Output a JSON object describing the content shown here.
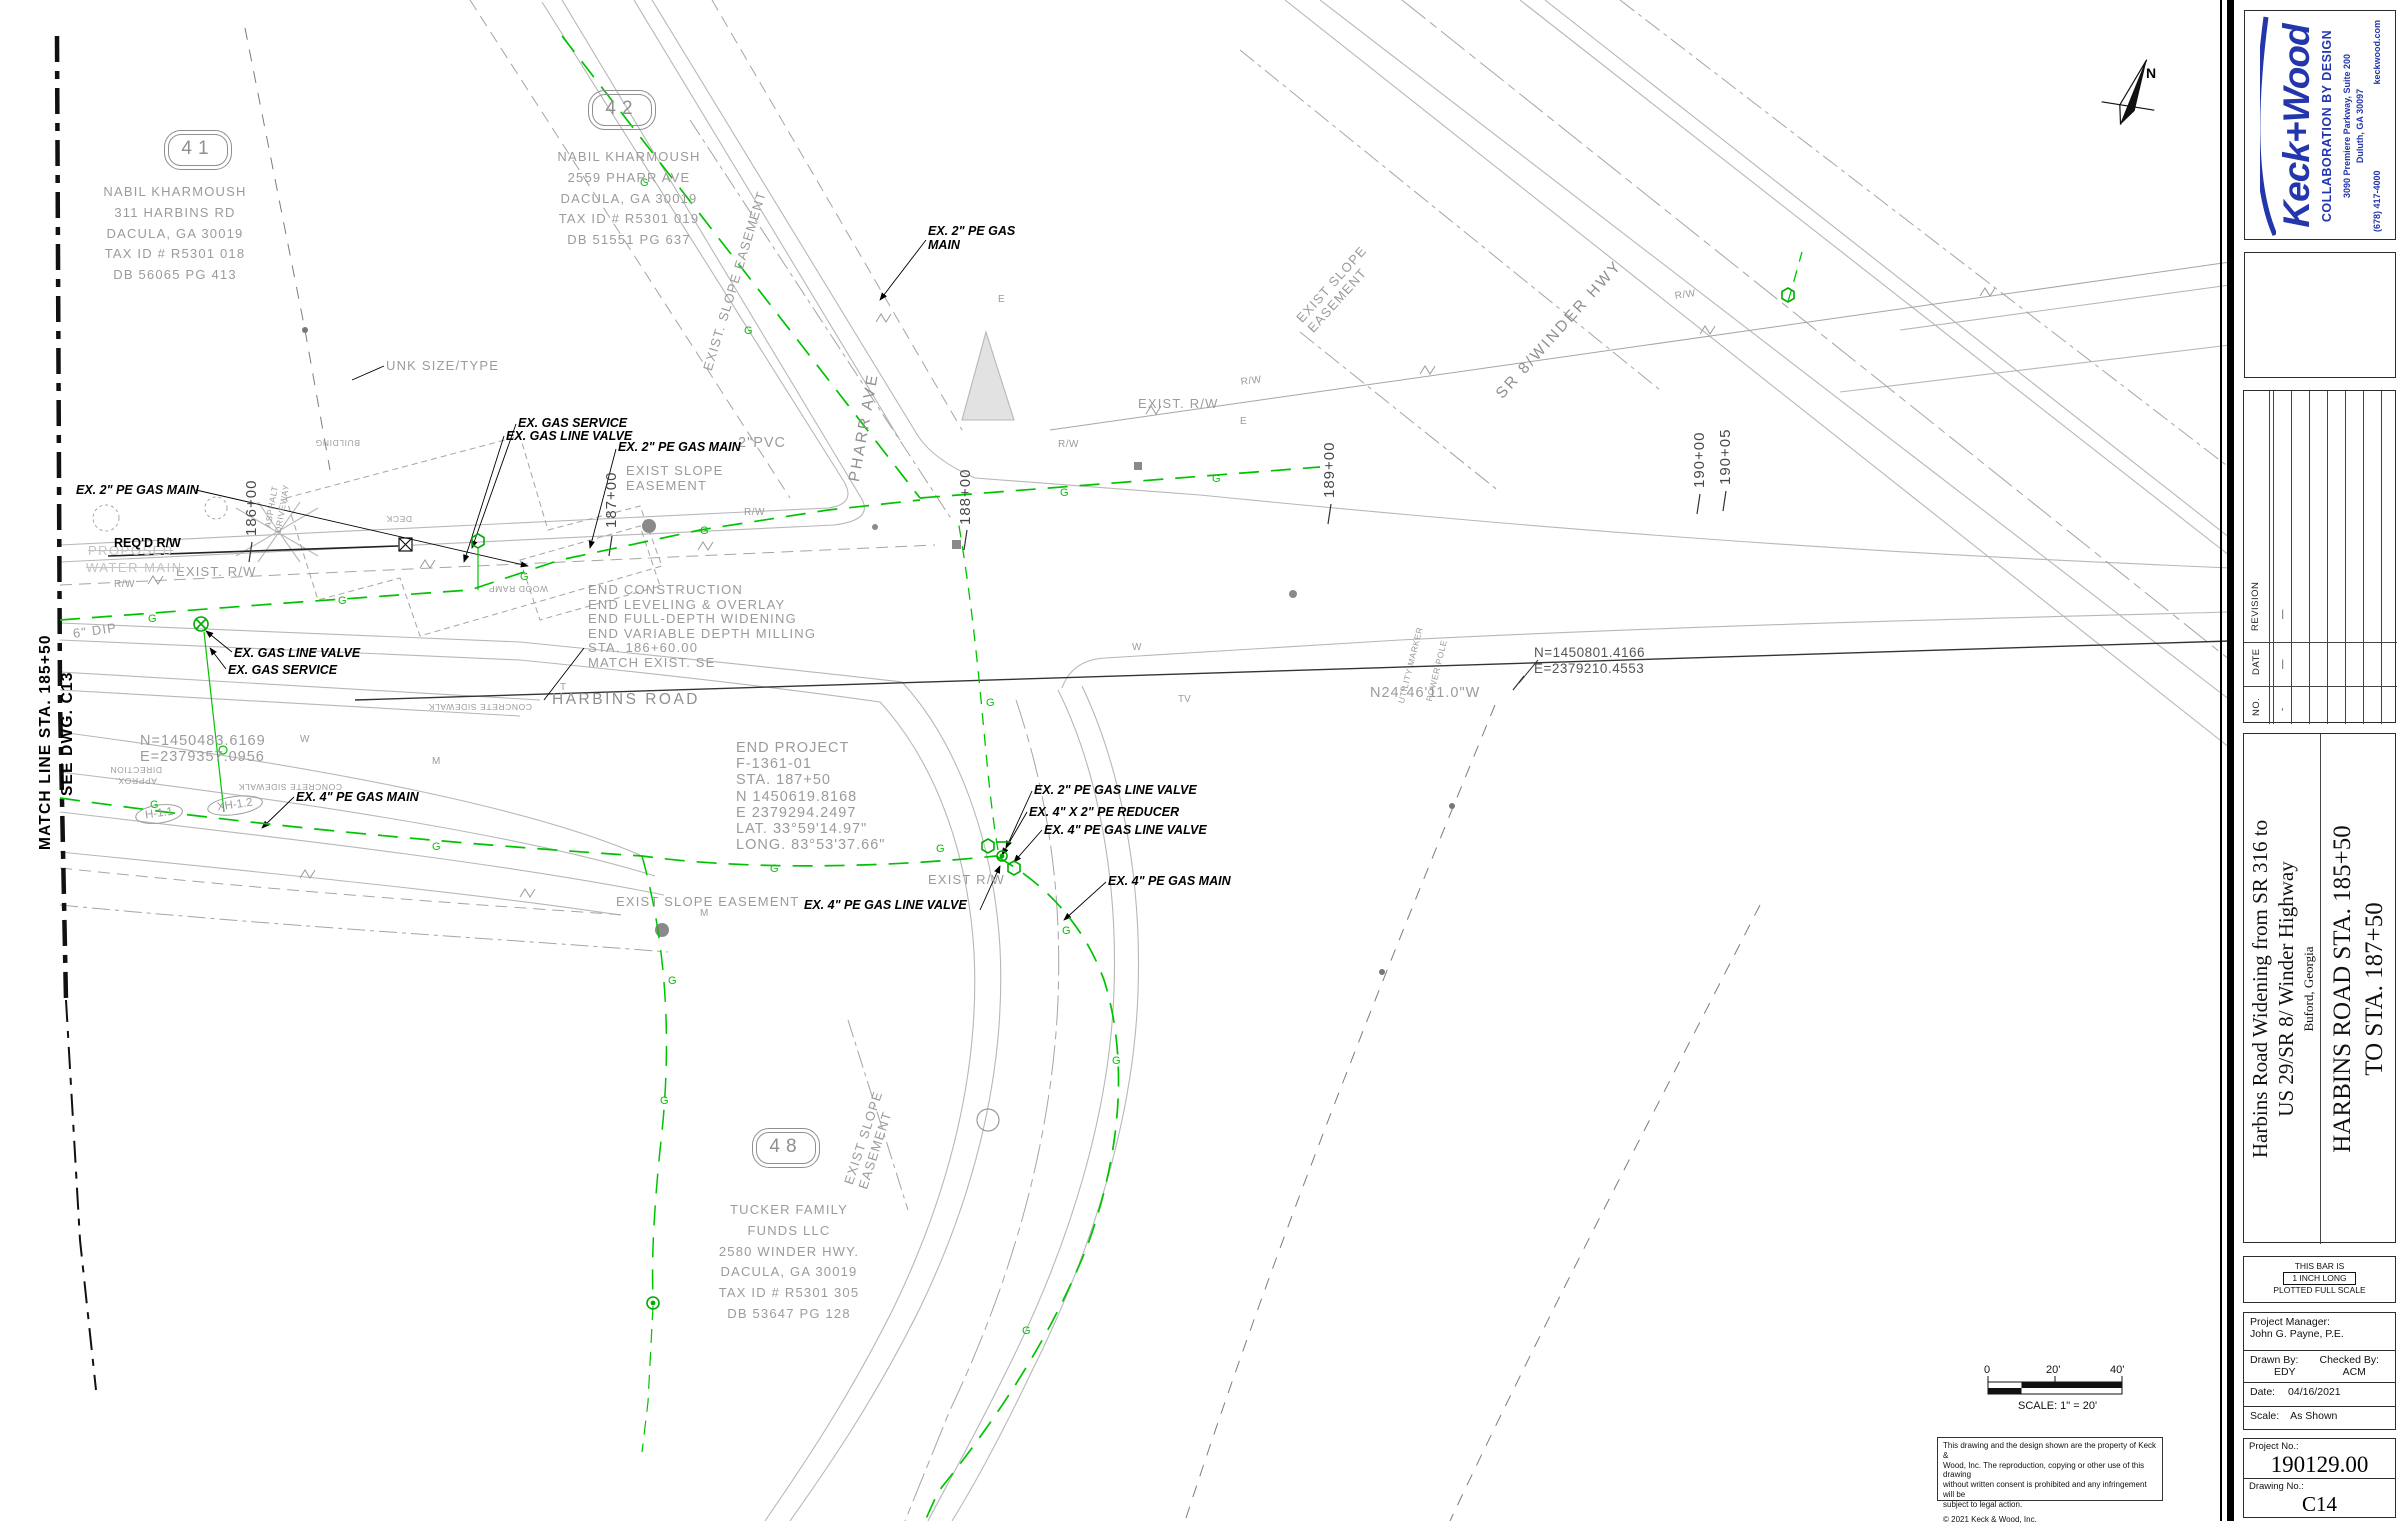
{
  "titleblock": {
    "firm": {
      "logo": "Keck+Wood",
      "tagline": "COLLABORATION BY DESIGN",
      "address1": "3090 Premiere Parkway, Suite 200",
      "address2": "Duluth, GA  30097",
      "phone": "(678) 417-4000",
      "web": "keckwood.com",
      "brand_color": "#2336ac"
    },
    "revision_table": {
      "col_no": "NO.",
      "col_date": "DATE",
      "col_revision": "REVISION",
      "rows": [
        {
          "no": "-",
          "date": "—",
          "revision": "—"
        }
      ]
    },
    "project_title_line1": "Harbins Road Widening from SR 316 to",
    "project_title_line2": "US 29/SR 8/ Winder Highway",
    "project_location": "Buford, Georgia",
    "sheet_title_line1": "HARBINS ROAD STA. 185+50",
    "sheet_title_line2": "TO STA. 187+50",
    "bar_note_1": "THIS BAR IS",
    "bar_note_2": "1 INCH LONG",
    "bar_note_3": "PLOTTED FULL SCALE",
    "info": {
      "pm_label": "Project Manager:",
      "pm": "John G. Payne, P.E.",
      "drawn_label": "Drawn By:",
      "drawn": "EDY",
      "checked_label": "Checked By:",
      "checked": "ACM",
      "date_label": "Date:",
      "date": "04/16/2021",
      "scale_label": "Scale:",
      "scale": "As Shown"
    },
    "project_no_label": "Project No.:",
    "project_no": "190129.00",
    "drawing_no_label": "Drawing No.:",
    "drawing_no": "C14"
  },
  "plan": {
    "scalebar": {
      "zero": "0",
      "mid": "20'",
      "end": "40'",
      "caption": "SCALE: 1\" =  20'"
    },
    "copyright": {
      "lines": [
        "This drawing and the design shown are the property of Keck &",
        "Wood, Inc. The reproduction, copying or other use of this drawing",
        "without written consent is prohibited and any infringement will be",
        "subject to legal action."
      ],
      "notice": "©  2021 Keck & Wood, Inc."
    },
    "linetype": {
      "gas": "G",
      "e": "E",
      "w": "W",
      "m": "M",
      "t": "T",
      "tv": "TV"
    },
    "labels": [
      {
        "name": "parcel-41-bubble",
        "text": "41",
        "x": 168,
        "y": 134,
        "w": 58,
        "cls": "bubble"
      },
      {
        "name": "parcel-41-address",
        "text": "NABIL KHARMOUSH\n311 HARBINS RD\nDACULA, GA 30019\nTAX ID # R5301 018\nDB 56065 PG 413",
        "x": 66,
        "y": 182,
        "w": 218,
        "cls": "cad loose center"
      },
      {
        "name": "parcel-42-bubble",
        "text": "42",
        "x": 592,
        "y": 94,
        "w": 58,
        "cls": "bubble"
      },
      {
        "name": "parcel-42-address",
        "text": "NABIL KHARMOUSH\n2559 PHARR AVE\nDACULA, GA 30019\nTAX ID # R5301 019\nDB 51551 PG 637",
        "x": 520,
        "y": 147,
        "w": 218,
        "cls": "cad loose center"
      },
      {
        "name": "parcel-48-bubble",
        "text": "48",
        "x": 756,
        "y": 1132,
        "w": 58,
        "cls": "bubble"
      },
      {
        "name": "parcel-48-address",
        "text": "TUCKER FAMILY\nFUNDS LLC\n2580 WINDER HWY.\nDACULA, GA 30019\nTAX ID # R5301 305\nDB 53647 PG 128",
        "x": 680,
        "y": 1200,
        "w": 218,
        "cls": "cad loose center"
      },
      {
        "name": "match-line-label",
        "text": "MATCH LINE STA. 185+50",
        "x": 36,
        "y": 850,
        "rot": -90,
        "cls": "mline"
      },
      {
        "name": "match-line-dwg-ref",
        "text": "SEE DWG. C13",
        "x": 58,
        "y": 796,
        "rot": -90,
        "cls": "mline"
      },
      {
        "name": "road-name-harbins",
        "text": "HARBINS ROAD",
        "x": 552,
        "y": 690,
        "cls": "cadlg"
      },
      {
        "name": "road-name-pharr",
        "text": "PHARR AVE",
        "x": 845,
        "y": 480,
        "rot": -80,
        "cls": "cadlg"
      },
      {
        "name": "road-name-sr8",
        "text": "SR 8/WINDER HWY",
        "x": 1492,
        "y": 390,
        "rot": -48,
        "cls": "cadlg"
      },
      {
        "name": "station-186",
        "text": "186+00",
        "x": 242,
        "y": 536,
        "rot": -90,
        "cls": "sta"
      },
      {
        "name": "station-187",
        "text": "187+00",
        "x": 602,
        "y": 528,
        "rot": -90,
        "cls": "sta"
      },
      {
        "name": "station-188",
        "text": "188+00",
        "x": 956,
        "y": 525,
        "rot": -90,
        "cls": "sta"
      },
      {
        "name": "station-189",
        "text": "189+00",
        "x": 1320,
        "y": 498,
        "rot": -90,
        "cls": "sta"
      },
      {
        "name": "station-190",
        "text": "190+00",
        "x": 1690,
        "y": 488,
        "rot": -90,
        "cls": "sta"
      },
      {
        "name": "station-190-05",
        "text": "190+05",
        "x": 1716,
        "y": 485,
        "rot": -90,
        "cls": "sta"
      },
      {
        "name": "end-construction-note",
        "text": "END CONSTRUCTION\nEND LEVELING & OVERLAY\nEND FULL-DEPTH WIDENING\nEND VARIABLE DEPTH MILLING\nSTA. 186+60.00\nMATCH EXIST. SE",
        "x": 588,
        "y": 583,
        "cls": "cad tight"
      },
      {
        "name": "end-project-note",
        "text": "END PROJECT\nF-1361-01\nSTA. 187+50\nN 1450619.8168\nE 2379294.2497\nLAT. 33°59'14.97\"\nLONG. 83°53'37.66\"",
        "x": 736,
        "y": 740,
        "cls": "cadbig tight"
      },
      {
        "name": "coordinate-west",
        "text": "N=1450483.6169\nE=2379357.0956",
        "x": 140,
        "y": 733,
        "cls": "cadbig tight"
      },
      {
        "name": "coordinate-east",
        "text": "N=1450801.4166\nE=2379210.4553",
        "x": 1534,
        "y": 645,
        "cls": "dark13"
      },
      {
        "name": "bearing-harbins",
        "text": "N24°46'11.0\"W",
        "x": 1370,
        "y": 684,
        "cls": "cadbig"
      },
      {
        "name": "exist-rw-left",
        "text": "EXIST. R/W",
        "x": 176,
        "y": 564,
        "cls": "cad"
      },
      {
        "name": "exist-rw-ne",
        "text": "EXIST. R/W",
        "x": 1138,
        "y": 396,
        "cls": "cad"
      },
      {
        "name": "exist-rw-s",
        "text": "EXIST R/W",
        "x": 928,
        "y": 872,
        "cls": "cad"
      },
      {
        "name": "slope-easement-pharr-w",
        "text": "EXIST SLOPE\nEASEMENT",
        "x": 626,
        "y": 464,
        "cls": "cad tight"
      },
      {
        "name": "slope-easement-pharr-e",
        "text": "EXIST. SLOPE EASEMENT",
        "x": 700,
        "y": 368,
        "rot": -73,
        "cls": "cad"
      },
      {
        "name": "slope-easement-s",
        "text": "EXIST SLOPE EASEMENT",
        "x": 616,
        "y": 894,
        "cls": "cad"
      },
      {
        "name": "slope-easement-charter",
        "text": "EXIST SLOPE\nEASEMENT",
        "x": 842,
        "y": 1182,
        "rot": -72,
        "cls": "cad tight"
      },
      {
        "name": "slope-easement-sr8",
        "text": "EXIST SLOPE\nEASEMENT",
        "x": 1294,
        "y": 316,
        "rot": -48,
        "cls": "cad tight"
      },
      {
        "name": "unknown-utility",
        "text": "UNK SIZE/TYPE",
        "x": 386,
        "y": 358,
        "cls": "cad"
      },
      {
        "name": "pvc-label",
        "text": "2\"PVC",
        "x": 738,
        "y": 434,
        "cls": "cadbig"
      },
      {
        "name": "dip-label",
        "text": "6\" DIP",
        "x": 72,
        "y": 626,
        "rot": -8,
        "cls": "cad"
      },
      {
        "name": "proposed-label",
        "text": "PROPOSED",
        "x": 88,
        "y": 543,
        "cls": "faded"
      },
      {
        "name": "water-main-label",
        "text": "WATER MAIN",
        "x": 86,
        "y": 560,
        "cls": "faded"
      },
      {
        "name": "building-label",
        "text": "BUILDING",
        "x": 360,
        "y": 448,
        "rot": 180,
        "cls": "cadxs"
      },
      {
        "name": "deck-label",
        "text": "DECK",
        "x": 412,
        "y": 524,
        "rot": 180,
        "cls": "cadxs"
      },
      {
        "name": "wood-ramp-label",
        "text": "WOOD RAMP",
        "x": 548,
        "y": 594,
        "rot": 180,
        "cls": "cadxs"
      },
      {
        "name": "asphalt-driveway-label",
        "text": "ASPHALT\nDRIVEWAY",
        "x": 262,
        "y": 530,
        "rot": -80,
        "cls": "cadxs center"
      },
      {
        "name": "concrete-sidewalk-1",
        "text": "CONCRETE SIDEWALK",
        "x": 532,
        "y": 712,
        "rot": 180,
        "cls": "cadxs"
      },
      {
        "name": "concrete-sidewalk-2",
        "text": "CONCRETE SIDEWALK",
        "x": 342,
        "y": 792,
        "rot": 180,
        "cls": "cadxs"
      },
      {
        "name": "approx-direction-label",
        "text": "APPROX.\nDIRECTION",
        "x": 162,
        "y": 786,
        "rot": 180,
        "cls": "cadxs center"
      },
      {
        "name": "structure-h11",
        "text": "H-1.1",
        "x": 134,
        "y": 808,
        "rot": -8,
        "cls": "ell"
      },
      {
        "name": "structure-xh12",
        "text": "XH-1.2",
        "x": 206,
        "y": 800,
        "rot": -8,
        "cls": "ell"
      },
      {
        "name": "utility-marker-label",
        "text": "UTILITY MARKER",
        "x": 1396,
        "y": 702,
        "rot": -76,
        "cls": "cadxs"
      },
      {
        "name": "power-pole-label",
        "text": "POWER POLE",
        "x": 1424,
        "y": 700,
        "rot": -76,
        "cls": "cadxs"
      },
      {
        "name": "gas-main-2in-west",
        "text": "EX. 2\" PE GAS MAIN",
        "x": 76,
        "y": 483,
        "cls": "ann"
      },
      {
        "name": "gas-service-north",
        "text": "EX. GAS SERVICE",
        "x": 518,
        "y": 416,
        "cls": "ann"
      },
      {
        "name": "gas-valve-north",
        "text": "EX. GAS LINE VALVE",
        "x": 506,
        "y": 429,
        "cls": "ann"
      },
      {
        "name": "gas-main-2in-center",
        "text": "EX. 2\" PE GAS MAIN",
        "x": 618,
        "y": 440,
        "cls": "ann"
      },
      {
        "name": "gas-main-2in-pharr",
        "text": "EX. 2\" PE GAS\nMAIN",
        "x": 928,
        "y": 224,
        "cls": "ann"
      },
      {
        "name": "gas-valve-west",
        "text": "EX. GAS LINE VALVE",
        "x": 234,
        "y": 646,
        "cls": "ann"
      },
      {
        "name": "gas-service-west",
        "text": "EX. GAS SERVICE",
        "x": 228,
        "y": 663,
        "cls": "ann"
      },
      {
        "name": "gas-main-4in-west",
        "text": "EX. 4\" PE GAS MAIN",
        "x": 296,
        "y": 790,
        "cls": "ann"
      },
      {
        "name": "gas-valve-2in-line",
        "text": "EX. 2\" PE GAS LINE VALVE",
        "x": 1034,
        "y": 783,
        "cls": "ann"
      },
      {
        "name": "gas-reducer",
        "text": "EX. 4\" X 2\" PE REDUCER",
        "x": 1029,
        "y": 805,
        "cls": "ann"
      },
      {
        "name": "gas-valve-4in-a",
        "text": "EX. 4\" PE GAS LINE VALVE",
        "x": 1044,
        "y": 823,
        "cls": "ann"
      },
      {
        "name": "gas-main-4in-east",
        "text": "EX. 4\" PE GAS MAIN",
        "x": 1108,
        "y": 874,
        "cls": "ann"
      },
      {
        "name": "gas-valve-4in-b",
        "text": "EX. 4\" PE GAS LINE VALVE",
        "x": 804,
        "y": 898,
        "cls": "ann"
      },
      {
        "name": "reqd-rw-label",
        "text": "REQ'D R/W",
        "x": 114,
        "y": 535,
        "cls": "annb"
      },
      {
        "name": "rw-tick-1",
        "text": "R/W",
        "x": 744,
        "y": 506,
        "cls": "cadsm"
      },
      {
        "name": "rw-tick-2",
        "text": "R/W",
        "x": 1058,
        "y": 438,
        "cls": "cadsm"
      },
      {
        "name": "rw-tick-3",
        "text": "R/W",
        "x": 1240,
        "y": 376,
        "rot": -7,
        "cls": "cadsm"
      },
      {
        "name": "rw-tick-4",
        "text": "R/W",
        "x": 1674,
        "y": 290,
        "rot": -8,
        "cls": "cadsm"
      },
      {
        "name": "rw-tick-5",
        "text": "R/W",
        "x": 114,
        "y": 578,
        "cls": "cadsm"
      },
      {
        "name": "north-letter",
        "text": "N",
        "x": 2146,
        "y": 64,
        "cls": "northN"
      }
    ]
  }
}
